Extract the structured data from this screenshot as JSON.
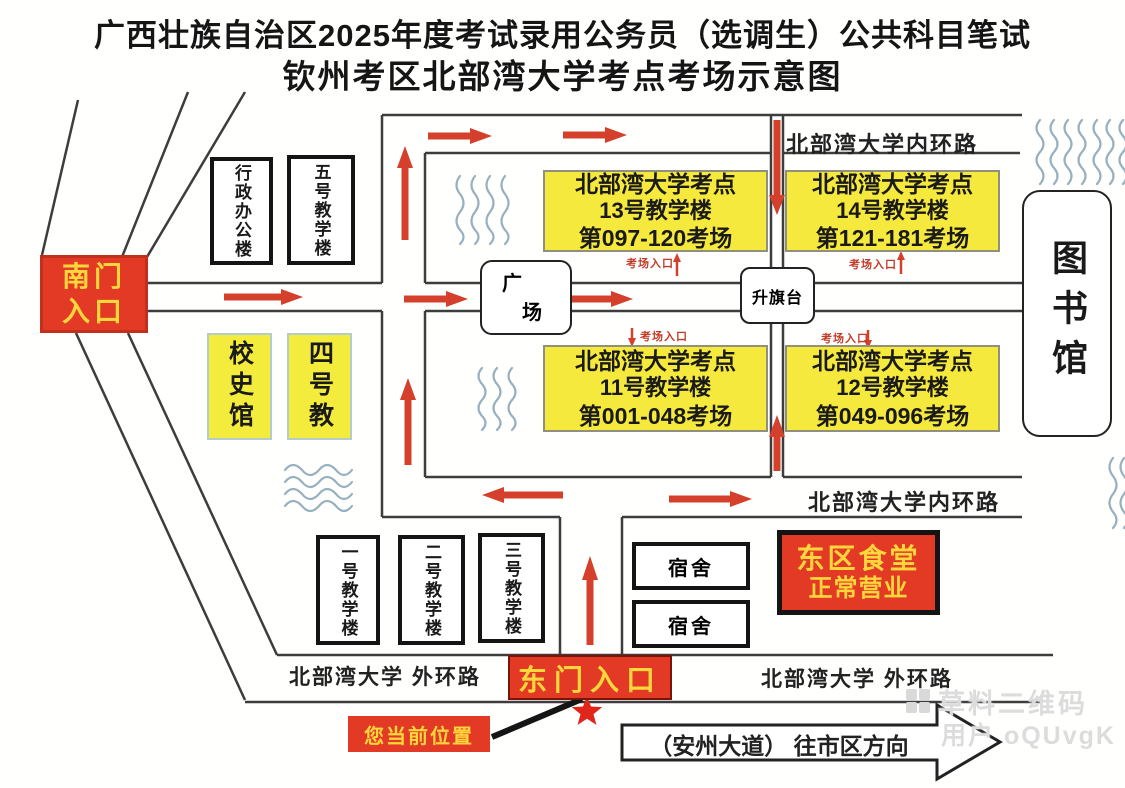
{
  "title": {
    "line1": "广西壮族自治区2025年度考试录用公务员（选调生）公共科目笔试",
    "line2": "钦州考区北部湾大学考点考场示意图"
  },
  "gates": {
    "south_line1": "南门",
    "south_line2": "入口",
    "east": "东门入口"
  },
  "buildings": {
    "admin_office": "行政办公楼",
    "teach_5": "五号教学楼",
    "school_history": "校史馆",
    "teach_4": "四号教",
    "plaza_char1": "广",
    "plaza_char2": "场",
    "flag_platform": "升旗台",
    "library": "图书馆",
    "teach_1": "一号教学楼",
    "teach_2": "二号教学楼",
    "teach_3": "三号教学楼",
    "dorm_1": "宿舍",
    "dorm_2": "宿舍",
    "canteen_line1": "东区食堂",
    "canteen_line2": "正常营业"
  },
  "exam_sites": [
    {
      "line1": "北部湾大学考点",
      "line2": "13号教学楼",
      "line3": "第097-120考场"
    },
    {
      "line1": "北部湾大学考点",
      "line2": "14号教学楼",
      "line3": "第121-181考场"
    },
    {
      "line1": "北部湾大学考点",
      "line2": "11号教学楼",
      "line3": "第001-048考场"
    },
    {
      "line1": "北部湾大学考点",
      "line2": "12号教学楼",
      "line3": "第049-096考场"
    }
  ],
  "entrances": {
    "b13": "考场入口",
    "b14": "考场入口",
    "b11": "考场入口",
    "b12": "考场入口"
  },
  "roads": {
    "inner_ring_top": "北部湾大学内环路",
    "inner_ring_bottom": "北部湾大学内环路",
    "outer_ring_left": "北部湾大学 外环路",
    "outer_ring_right": "北部湾大学 外环路",
    "avenue": "（安州大道） 往市区方向"
  },
  "annotations": {
    "current_location": "您当前位置"
  },
  "watermark": {
    "brand": "草料二维码",
    "user": "用户 oQUvgK"
  },
  "colors": {
    "gate_red": "#e23a24",
    "gate_text_yellow": "#ffd63c",
    "exam_box_yellow": "#f5e93d",
    "building_yellow": "#f4ec3d",
    "arrow_red": "#d4402c",
    "road_line": "#3d3d3d",
    "wave_blue": "#96b0bf",
    "entrance_red": "#c23a28",
    "watermark_gray": "#dcdcdc"
  }
}
